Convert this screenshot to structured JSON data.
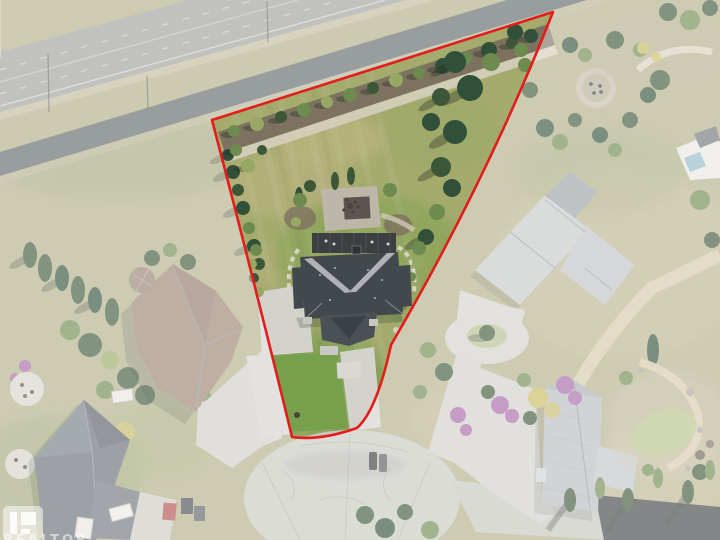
{
  "description": "Aerial drone photo of a pie-shaped residential lot outlined in red, bordered by a divided highway at top, a cul-de-sac at bottom, and neighboring acreage estates shown faded outside the boundary line.",
  "watermark": {
    "text": "REALTOR"
  },
  "boundary": {
    "path": "M 212,120 L 553,12 Q 487,180 391,345 Q 377,410 357,428 Q 320,441 292,437 Q 256,288 212,120 Z",
    "wash_path": "M0,0 H720 V540 H0 Z M 212,120 L 553,12 Q 487,180 391,345 Q 377,410 357,428 Q 320,441 292,437 Q 256,288 212,120 Z",
    "stroke_width": 2.6,
    "wash_opacity": 0.36
  },
  "palette": {
    "boundary_red": "#e21d1c",
    "wash_white": "#ffffff",
    "base_grass": "#b2ae88",
    "property_lawn": "#a4ab6d",
    "front_lawn": "#76a04b",
    "highway": "#9fa09b",
    "service_road": "#5f6668",
    "concrete": "#d3d2cb",
    "culdesac": "#c9c8c1",
    "street_asphalt": "#3f4345",
    "house_roof": "#43484c",
    "roof_valley": "#b9bdc0",
    "left_roof": "#9b8270",
    "bottomleft_roof": "#666c72",
    "mansion_roof": "#c6c8c9",
    "bottomright_roof": "#b7bcc0",
    "tree_dark": "#3c5638",
    "tree_mid": "#6d8a4f",
    "tree_light": "#96a863",
    "spruce": "#31503a",
    "autumn_yellow": "#c9bb5e",
    "autumn_purple": "#a566a8",
    "mulch": "#7d7260",
    "gravel": "#d6cfbd",
    "stone_path": "#d9ccab",
    "pool_water": "#8fb9c6"
  }
}
